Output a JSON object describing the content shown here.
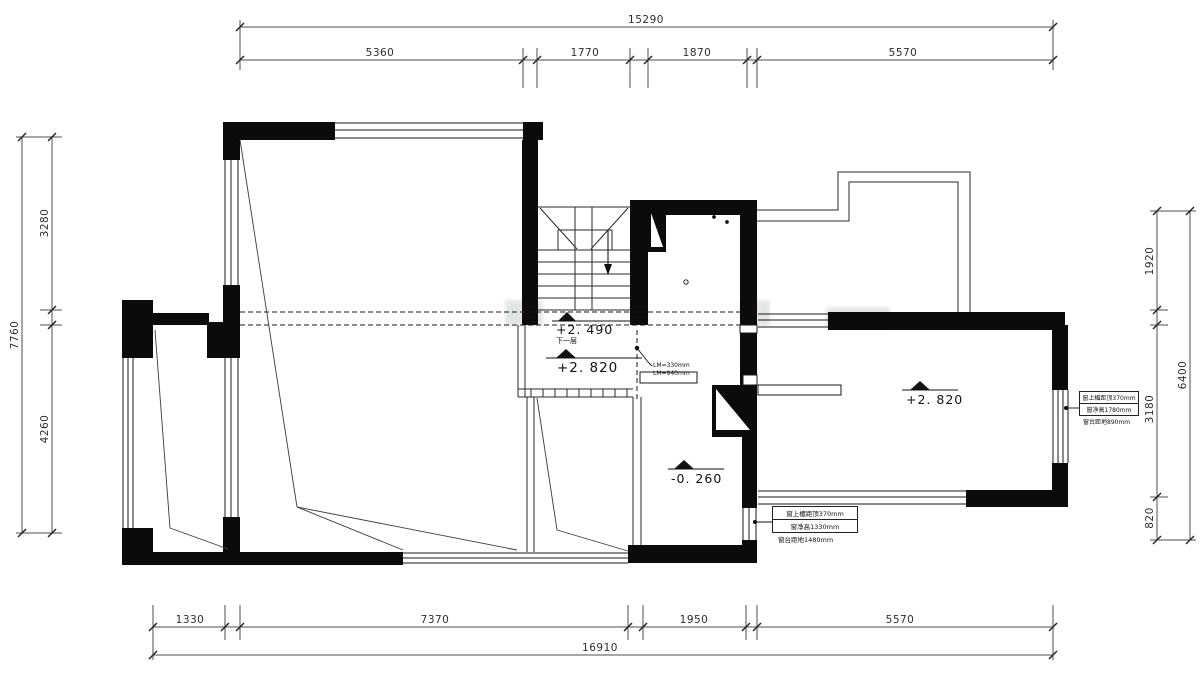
{
  "drawing": {
    "type": "residential floor plan (CAD)",
    "levels": {
      "stair": "+2. 490",
      "stair_sub": "下一层",
      "landing": "+2. 820",
      "right_room": "+2. 820",
      "middle_room": "-0. 260"
    },
    "dimensions": {
      "top": {
        "overall": "15290",
        "segments": [
          "5360",
          "1770",
          "1870",
          "5570"
        ]
      },
      "bottom": {
        "overall": "16910",
        "segments": [
          "1330",
          "7370",
          "1950",
          "5570"
        ]
      },
      "left": {
        "overall": "7760",
        "segments": [
          "3280",
          "4260"
        ]
      },
      "right": {
        "overall": "6400",
        "segments": [
          "1920",
          "3180",
          "820"
        ]
      }
    },
    "notes": {
      "stair_lm": [
        "LM=330mm",
        "LM=940mm"
      ],
      "window_right": [
        "窗上楣距顶370mm",
        "窗净高1780mm",
        "窗台距地890mm"
      ],
      "window_bottom": [
        "窗上楣距顶370mm",
        "窗净高1330mm",
        "窗台距地1480mm"
      ]
    }
  }
}
